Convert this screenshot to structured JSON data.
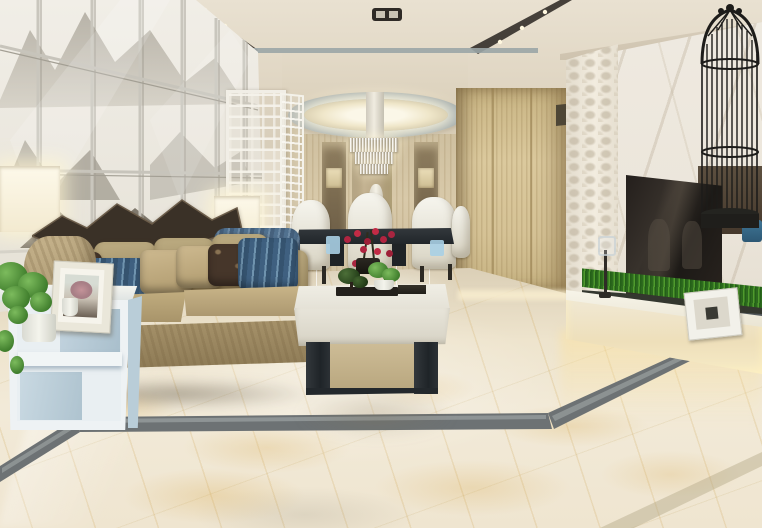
{
  "scene": {
    "type": "interior-3d-render",
    "room": "open-plan living and dining room, modern Chinese style",
    "no_visible_text": true,
    "palette": {
      "ceiling": "#e0d6c3",
      "ceiling_tray_strip": "#4a433a",
      "art_wall": "#eceae3",
      "ink_painting_gray": "#8a8478",
      "dining_wood_wall": "#d3c4a4",
      "wardrobe_wood": "#d5c295",
      "marble_wall": "#ece6db",
      "tv_screen": "#1c1916",
      "birdcage_black": "#1d1c1a",
      "sofa_tan": "#a6926a",
      "pillow_blue": "#4e6e8d",
      "pillow_brown": "#46362a",
      "armchair_blue": "#51718f",
      "floor_marble_cream": "#efe5d0",
      "floor_vein_gold": "#d8aa50",
      "floor_border_gray": "#6d7274",
      "side_table_white": "#e9eff2",
      "coffee_table_white": "#e8e5da",
      "coffee_table_base": "#23282c",
      "console_white": "#f0e8d3",
      "grass_green": "#4f9a2d",
      "orchid_red": "#b02440",
      "lamp_glow": "#fdf9ea"
    },
    "objects": [
      {
        "id": "art-wall",
        "label": "framed ink-wash landscape panel wall"
      },
      {
        "id": "driftwood-art",
        "label": "dark sculptural driftwood art above sofa"
      },
      {
        "id": "lattice-screen",
        "label": "white Chinese fretwork divider screen"
      },
      {
        "id": "oval-ceiling-recess",
        "label": "oval recessed ceiling light over dining"
      },
      {
        "id": "crystal-chandelier",
        "label": "tiered crystal chandelier"
      },
      {
        "id": "dining-set",
        "label": "dark dining table with white high-back chairs"
      },
      {
        "id": "orchid-centerpiece",
        "label": "red orchid arrangement"
      },
      {
        "id": "display-vase",
        "label": "tall white vase in dining niche"
      },
      {
        "id": "wardrobe",
        "label": "light wood wardrobe cabinet"
      },
      {
        "id": "textured-wall-panel",
        "label": "quilted 3D accent wall strip"
      },
      {
        "id": "marble-tv-wall",
        "label": "white marble feature wall"
      },
      {
        "id": "tv-screen",
        "label": "wall-mounted flat-screen TV"
      },
      {
        "id": "birdcage",
        "label": "tall black decorative birdcage"
      },
      {
        "id": "tv-console",
        "label": "white low media console with under-lighting"
      },
      {
        "id": "grass-planter",
        "label": "long artificial grass planter"
      },
      {
        "id": "console-photo-frame",
        "label": "small white photo frame on console"
      },
      {
        "id": "candlestick",
        "label": "slim candlestick on console"
      },
      {
        "id": "sofa",
        "label": "tan fabric sofa with patterned pillows"
      },
      {
        "id": "accent-armchair",
        "label": "blue patterned armchair"
      },
      {
        "id": "table-lamp",
        "label": "square white table lamp (lit)"
      },
      {
        "id": "floor-lamp",
        "label": "glowing lamp shade at left edge"
      },
      {
        "id": "side-table",
        "label": "white geometric side table"
      },
      {
        "id": "potted-plant",
        "label": "green potted plant"
      },
      {
        "id": "side-photo-frame",
        "label": "photo frame with pink tree picture"
      },
      {
        "id": "coffee-table",
        "label": "white coffee table with dark metal base"
      },
      {
        "id": "bonsai-plant",
        "label": "bonsai and small plant on coffee table"
      },
      {
        "id": "marble-floor",
        "label": "glossy gold-vein marble tile floor"
      },
      {
        "id": "floor-border-inlay",
        "label": "dark gray marble border inlay"
      }
    ]
  }
}
